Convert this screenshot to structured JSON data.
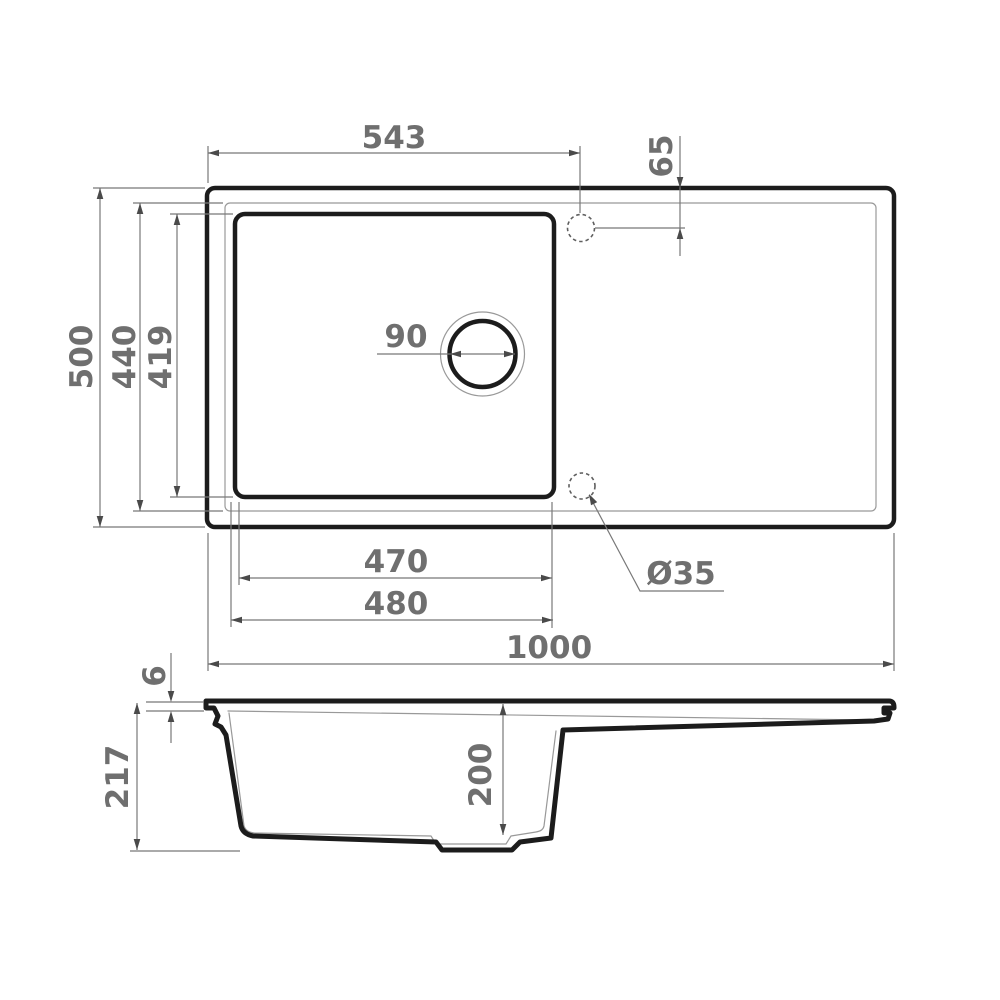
{
  "drawing": {
    "subject": "kitchen sink with drainboard - dimensioned technical drawing",
    "units": "mm",
    "views": {
      "top": "top view",
      "side": "section view"
    }
  },
  "colors": {
    "background": "#ffffff",
    "outline": "#1c1c1c",
    "thin_line": "#999999",
    "dim_line": "#787878",
    "arrow": "#4a4a4a",
    "text": "#6f6f6f",
    "hole_dash": "#5f5f5f"
  },
  "dims": {
    "faucet_center_from_left": "543",
    "faucet_center_from_top": "65",
    "overall_width": "500",
    "cutout_width": "440",
    "bowl_inner_width": "419",
    "drain_diameter": "90",
    "bowl_inner_length": "470",
    "bowl_outer_length": "480",
    "overall_length": "1000",
    "hole_diameter": "Ø35",
    "rim_thickness": "6",
    "overall_depth": "217",
    "bowl_depth": "200"
  }
}
